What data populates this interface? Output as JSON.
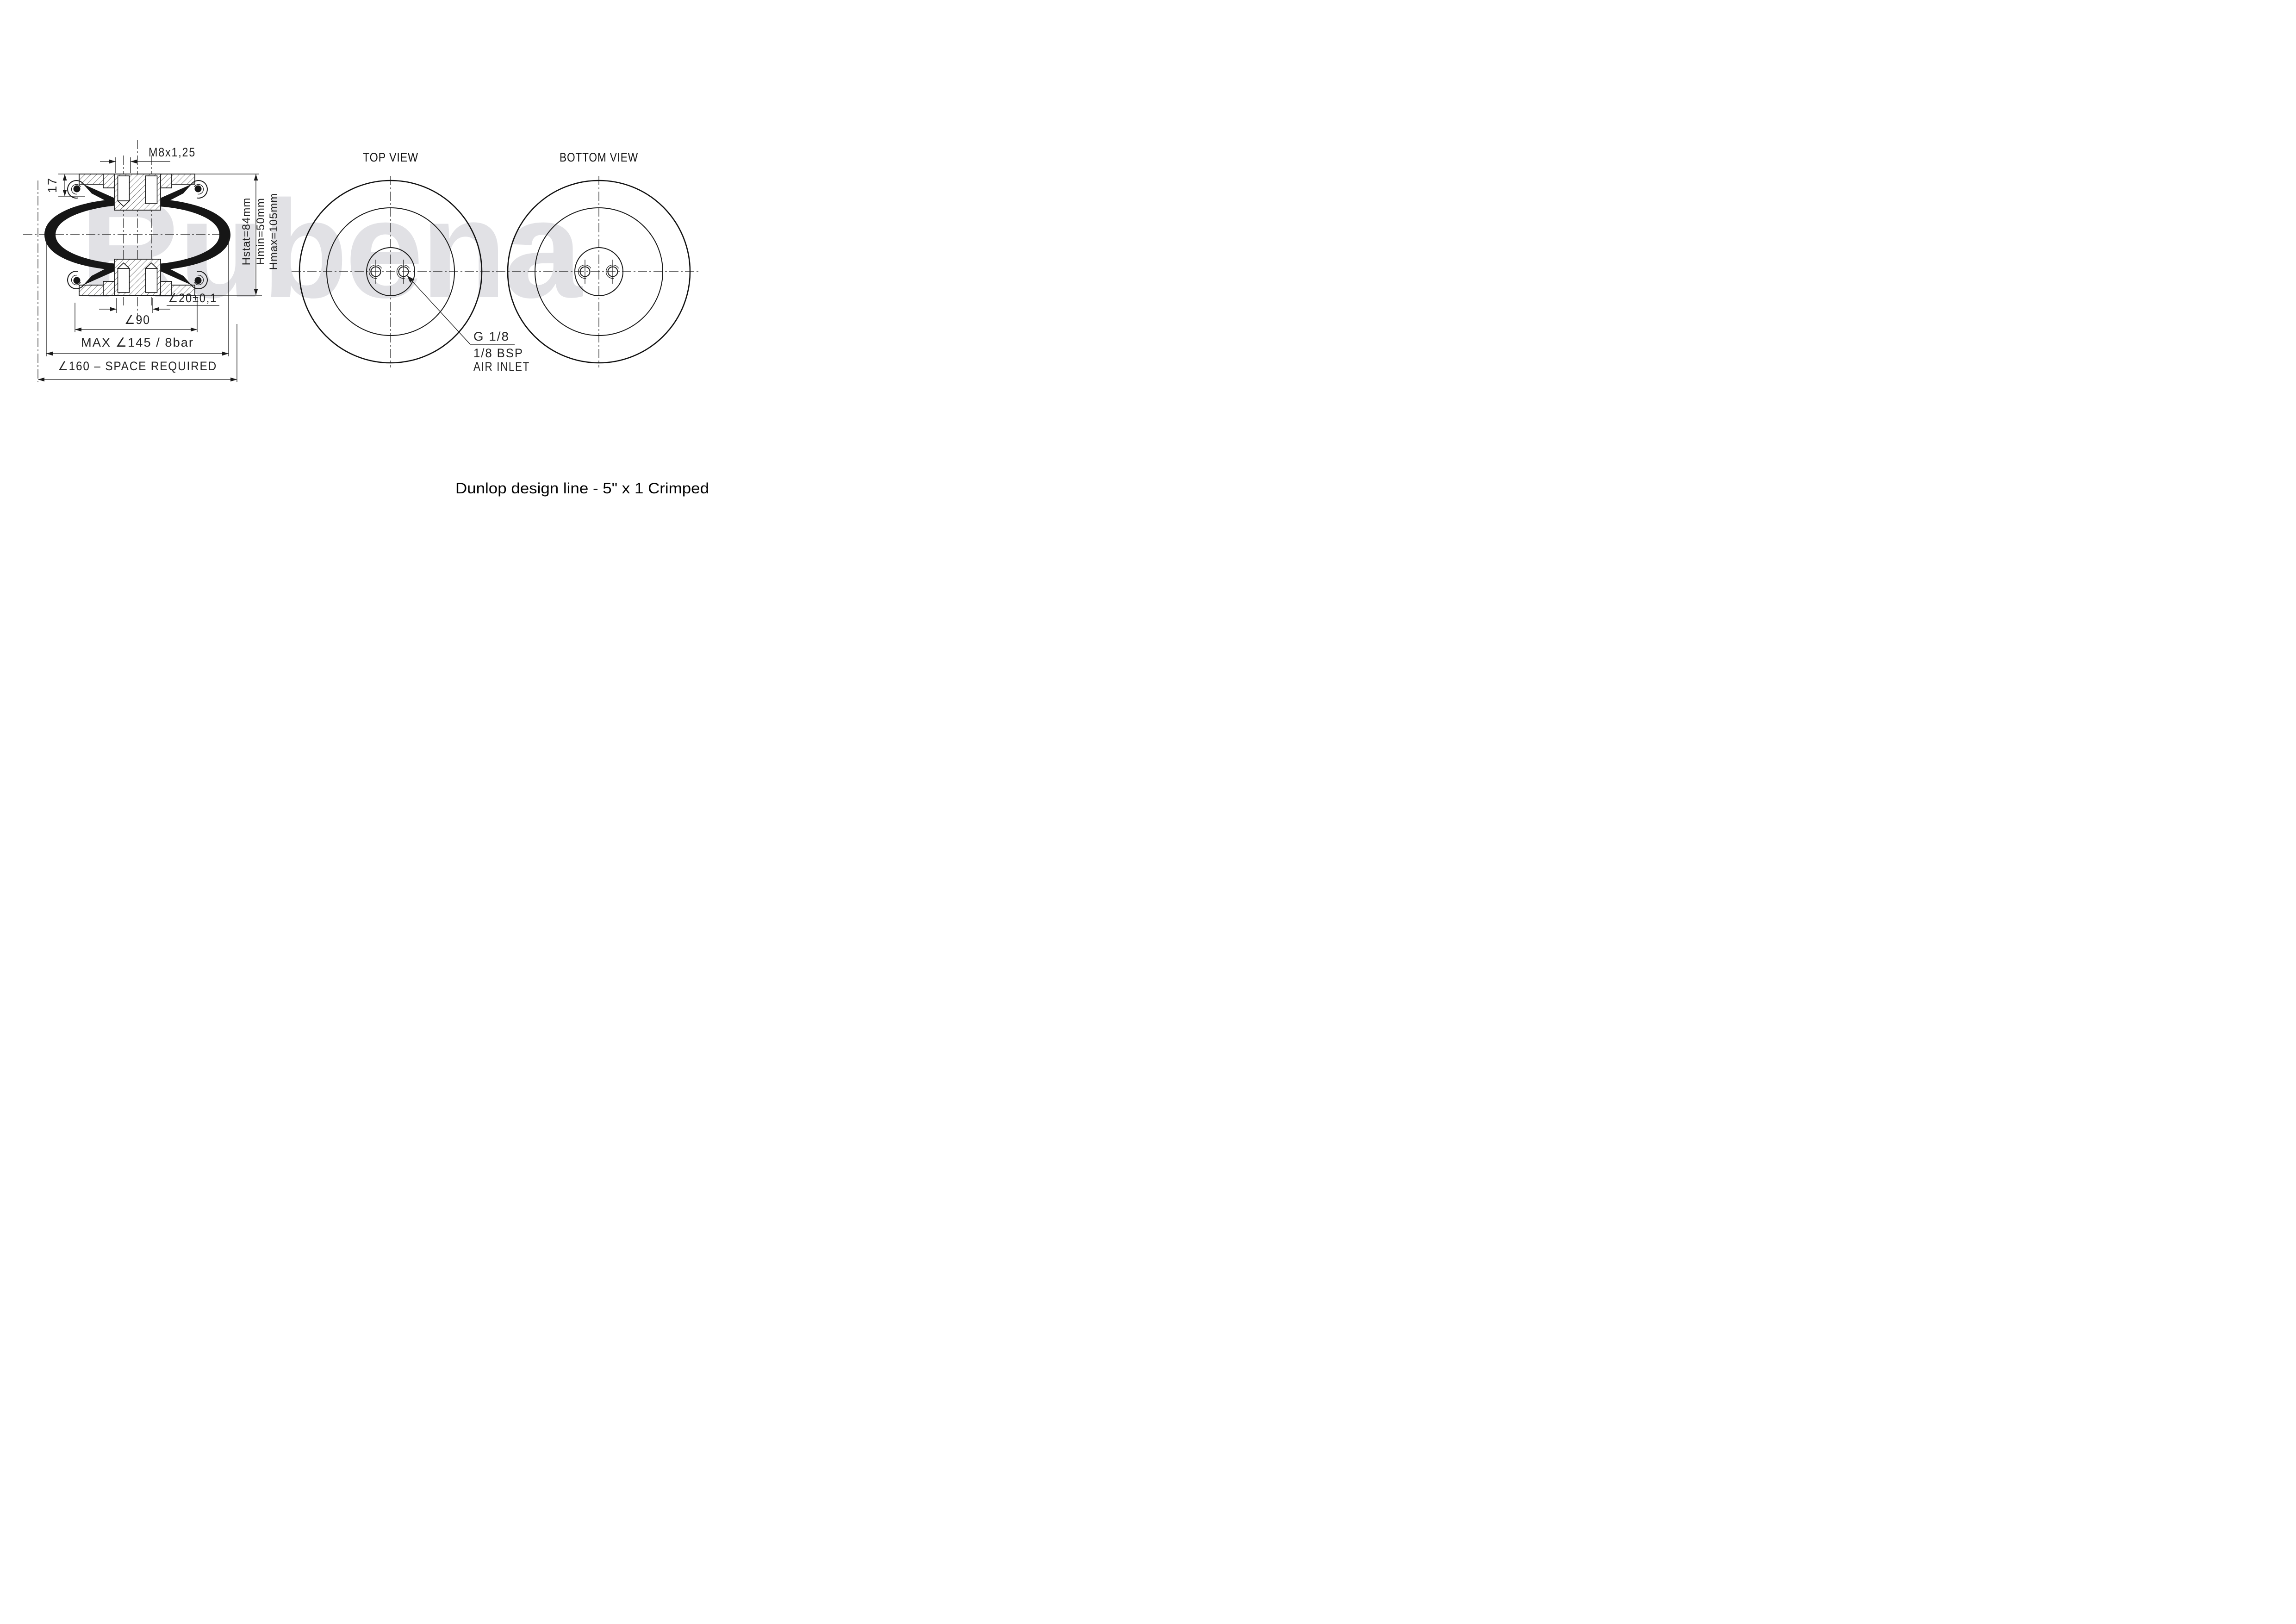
{
  "watermark": "Rubena",
  "footer": {
    "title": "Dunlop design line - 5\" x 1 Crimped"
  },
  "section_view": {
    "thread_label": "M8x1,25",
    "plate_height_label": "17",
    "hstat_label": "Hstat=84mm",
    "hmin_label": "Hmin=50mm",
    "hmax_label": "Hmax=105mm",
    "stud_pitch_label": "∠20±0,1",
    "plate_dia_label": "∠90",
    "max_dia_label": "MAX ∠145 / 8bar",
    "space_label": "∠160 – SPACE REQUIRED"
  },
  "top_view": {
    "title": "TOP VIEW"
  },
  "bottom_view": {
    "title": "BOTTOM VIEW"
  },
  "air_inlet": {
    "thread": "G 1/8",
    "bsp": "1/8 BSP",
    "label": "AIR INLET"
  },
  "colors": {
    "line": "#1a1a1a",
    "watermark": "#e1e1e5",
    "background": "#ffffff"
  }
}
